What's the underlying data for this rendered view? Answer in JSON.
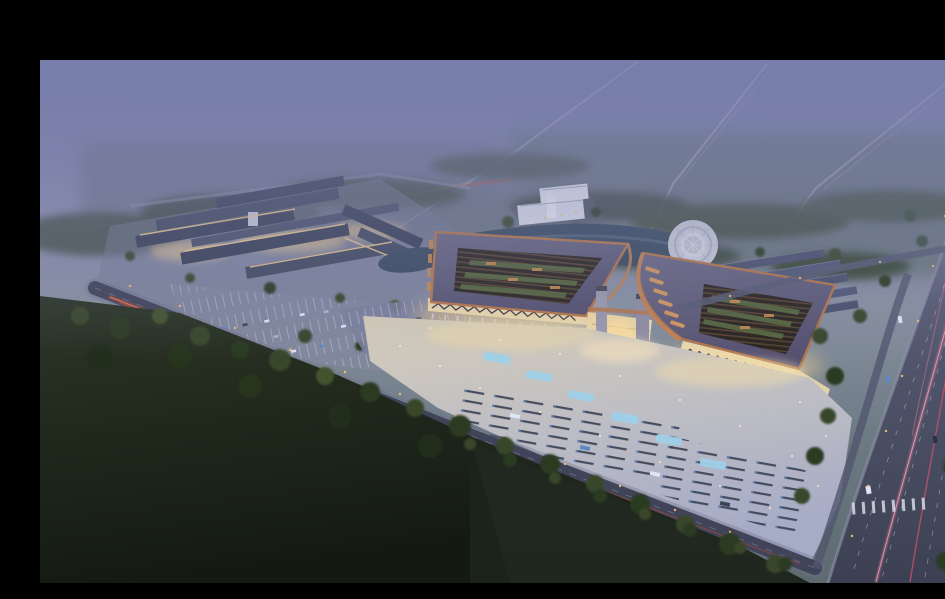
{
  "meta": {
    "title": "Aerial dusk rendering of a market hall campus",
    "alt": "Night-time aerial architectural rendering: two large pavilions with upturned copper-trimmed roofs and glowing colonnades face a lit plaza with parking rows; a secondary building cluster with its own parking lot sits to the west; a pond with a circular fountain plaza, a white office block and rows of long warehouses sit behind; roads with red and pink light trails cross dark fields and tree belts under a foggy violet sky, letterboxed with black bars on the top and right edges."
  },
  "palette": {
    "letterbox": "#000000",
    "skyTop": "#6b73a7",
    "skyMid": "#8b8fb0",
    "skyLow": "#87909f",
    "hazeGreen": "#6d7a84",
    "fog": "#7c81aa",
    "fogRoad": "#b8bcd4",
    "treeBand": "#45524a",
    "treeDark": "#2c3a24",
    "treeMid": "#37462c",
    "treeLite": "#42532f",
    "fieldTop": "#2c3626",
    "fieldBot": "#141a12",
    "plotBase": "#757a96",
    "roofBar": "#394056",
    "roofRow": "#4a516c",
    "pavRoofA": "#6b6983",
    "pavRoofB": "#555170",
    "copper": "#b5774a",
    "copperLite": "#c08253",
    "amber": "#d89a5e",
    "slatBg": "#2a2420",
    "slatLine": "#5a462f",
    "courtGreen": "#57693f",
    "warm": "#ecd9ab",
    "warmGlow": "#f3cf8e",
    "lamp": "#f6bf6f",
    "plazaTop": "#d6cdb9",
    "plazaBot": "#a6abc6",
    "pool": "#9fd0e8",
    "stallDark": "#394053",
    "stallLite": "#c3c8de",
    "roadDark": "#3f4459",
    "roadCase": "#6c7188",
    "roadV1": "#9094ab",
    "roadV2": "#3c4052",
    "redTrail": "#d6492e",
    "redCore": "#ff8a5c",
    "pink": "#e07a9a",
    "pinkDeep": "#c9506e",
    "white": "#dfe6f2",
    "carBlue": "#5e88c0",
    "water": "#394a5f",
    "waterLit": "#5d7390",
    "bldgWhite": "#dfe2ec",
    "fountain": "#c9cdd9"
  },
  "scene": {
    "letterbox": {
      "top_bar_height_px": 44,
      "right_bar_width_px": 9
    },
    "time_of_day": "dusk, heavy fog over distant fields",
    "elements": [
      {
        "name": "main-pavilion-west",
        "desc": "large hall, open slatted roof with green courtyard strips, copper trim, lit colonnade"
      },
      {
        "name": "main-pavilion-east",
        "desc": "matching hall with sweeping upturned eave and glowing amber louvers"
      },
      {
        "name": "central-gate",
        "desc": "lit gate structure linking the two pavilions"
      },
      {
        "name": "event-plaza",
        "desc": "lit forecourt with parking stall rows, cyan fountain pools, scattered lights"
      },
      {
        "name": "west-complex",
        "desc": "cluster of long gable buildings with lit facades and front parking lot"
      },
      {
        "name": "white-office-building",
        "desc": "small white block behind the pavilions"
      },
      {
        "name": "pond-and-fountain",
        "desc": "dark pond with round white fountain plaza"
      },
      {
        "name": "warehouse-rows",
        "desc": "parallel long buildings with blue-grey roofs, east of the pond"
      },
      {
        "name": "front-road",
        "desc": "diagonal road with red tail-light trails"
      },
      {
        "name": "east-highway",
        "desc": "wide vertical road with pink light trails, lane dashes, crosswalk"
      },
      {
        "name": "foreground-forest",
        "desc": "dark field and tree belt across the bottom-left"
      },
      {
        "name": "fog-roads",
        "desc": "faint straight roads fading into the misty horizon"
      }
    ],
    "counts": {
      "pavilions": 2,
      "warehouse_rows": 8,
      "fountain_pools": 6,
      "light_trail_colors": [
        "red",
        "pink"
      ]
    }
  }
}
